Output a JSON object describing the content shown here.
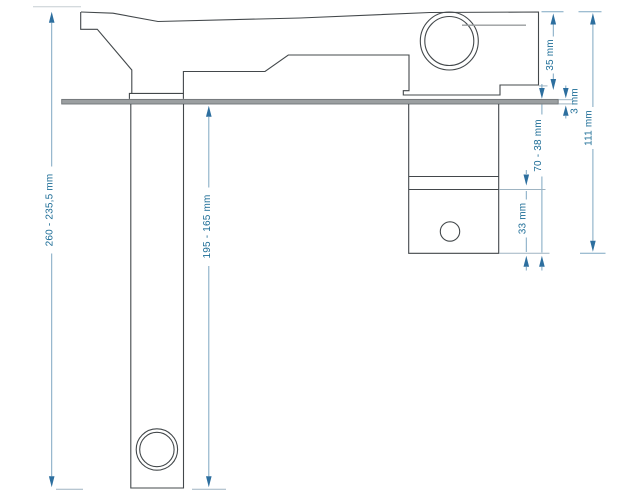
{
  "drawing": {
    "unit": "mm",
    "labels": {
      "total_height": "260 - 235,5 mm",
      "under_counter_clearance": "195 - 165 mm",
      "body_height": "35 mm",
      "counter_thickness": "3 mm",
      "clamping_range": "70 - 38 mm",
      "lower_shaft": "33 mm",
      "right_total": "111 mm"
    },
    "colors": {
      "dimension_text": "#1c6c96",
      "dimension_line": "#7ea7c2",
      "arrow": "#2d6f9f",
      "outline": "#43484b",
      "plate": "#9b9fa1"
    }
  }
}
